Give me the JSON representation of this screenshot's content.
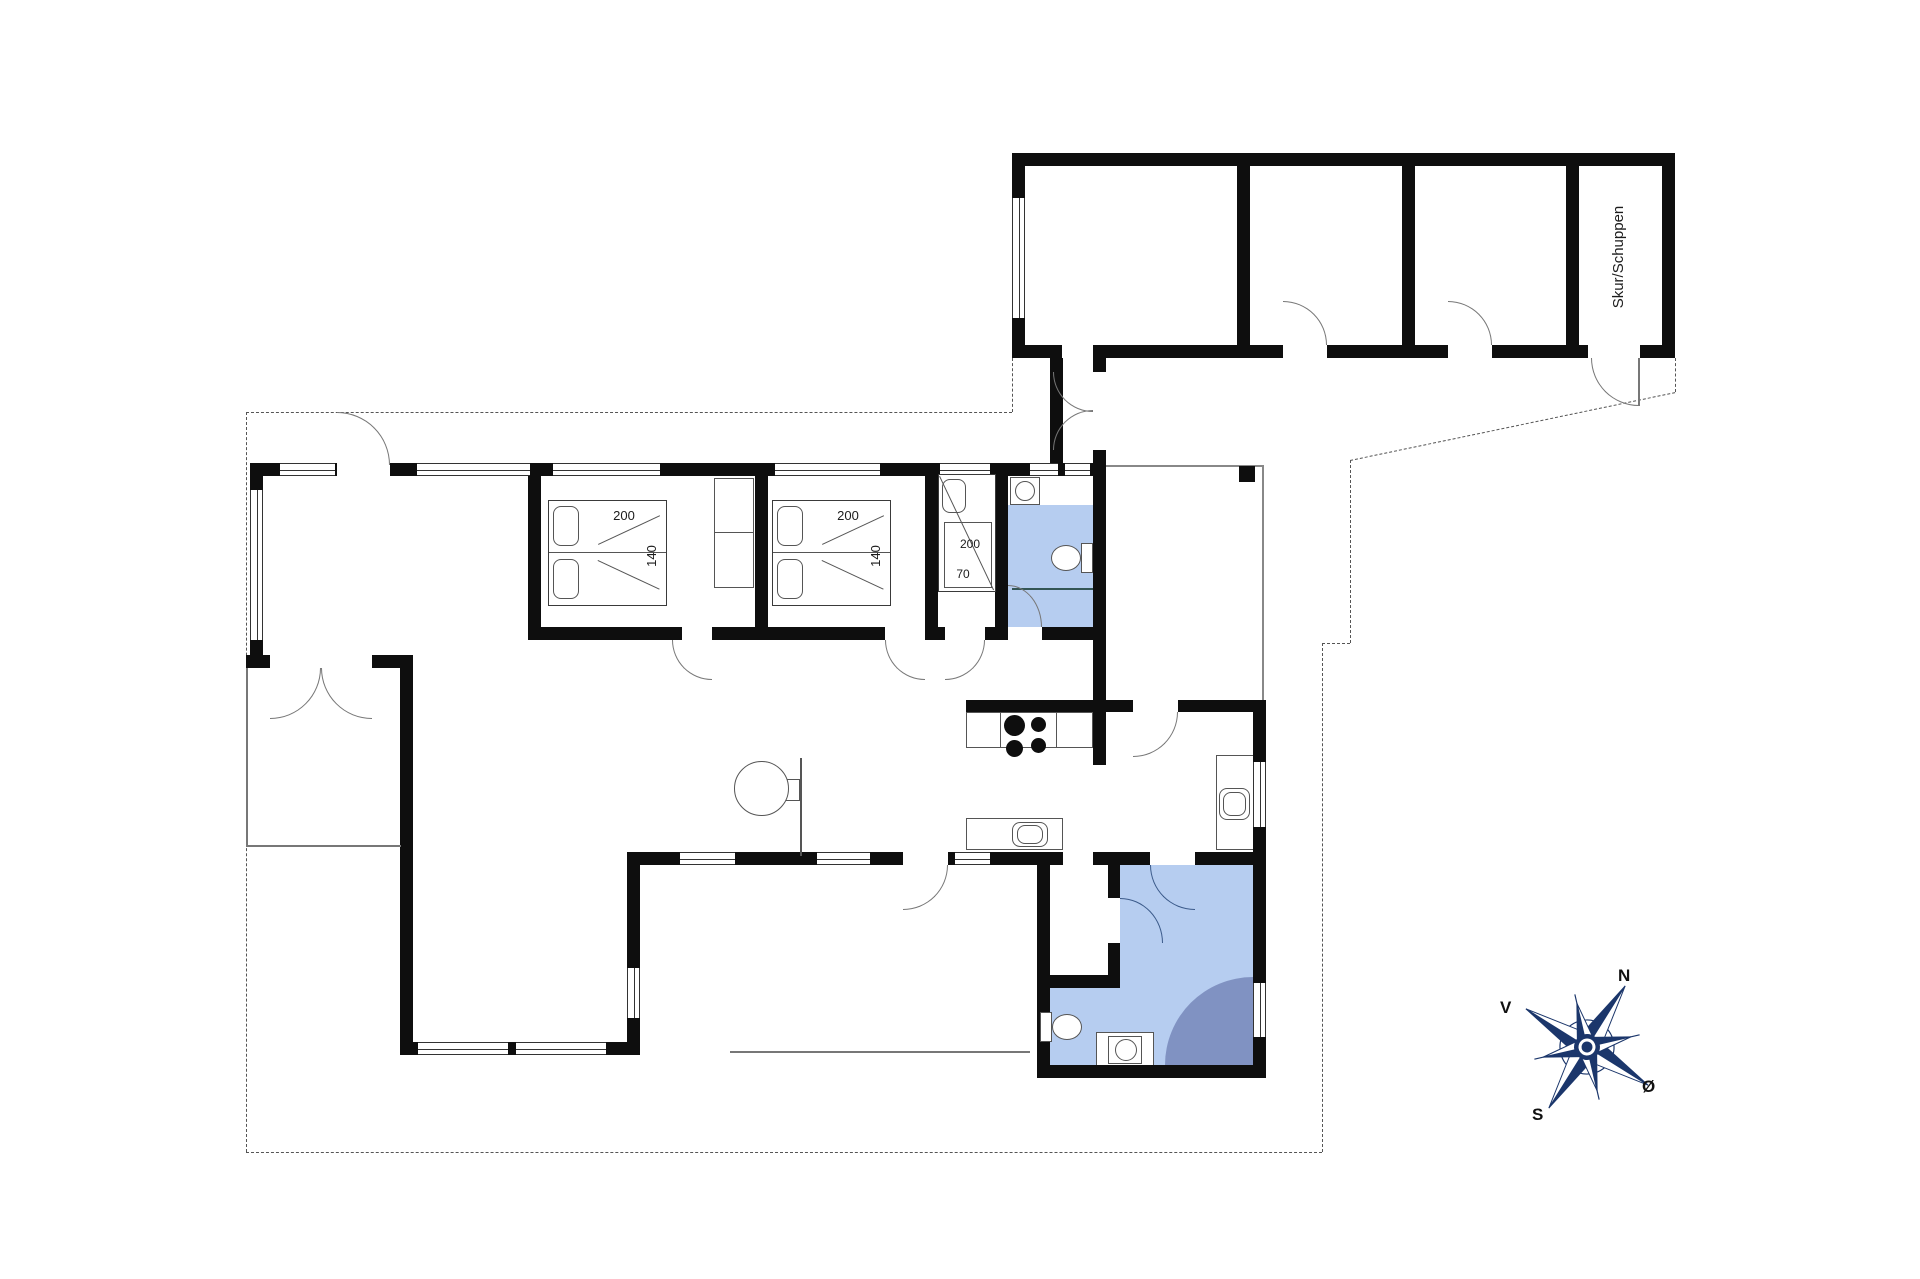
{
  "plan": {
    "annex": {
      "shed_label": "Skur/Schuppen"
    },
    "bedroom1": {
      "bed_length": "200",
      "bed_width": "140"
    },
    "bedroom2": {
      "bed_length": "200",
      "bed_width": "140"
    },
    "bunk_room": {
      "bed_length": "200",
      "bed_width": "70"
    },
    "compass": {
      "north": "N",
      "west": "V",
      "south": "S",
      "east": "Ø"
    },
    "colors": {
      "bathroom_floor": "#b6cdf0",
      "shower": "#8092c2",
      "compass_navy": "#1b366b",
      "wall": "#0e0e0e"
    }
  }
}
